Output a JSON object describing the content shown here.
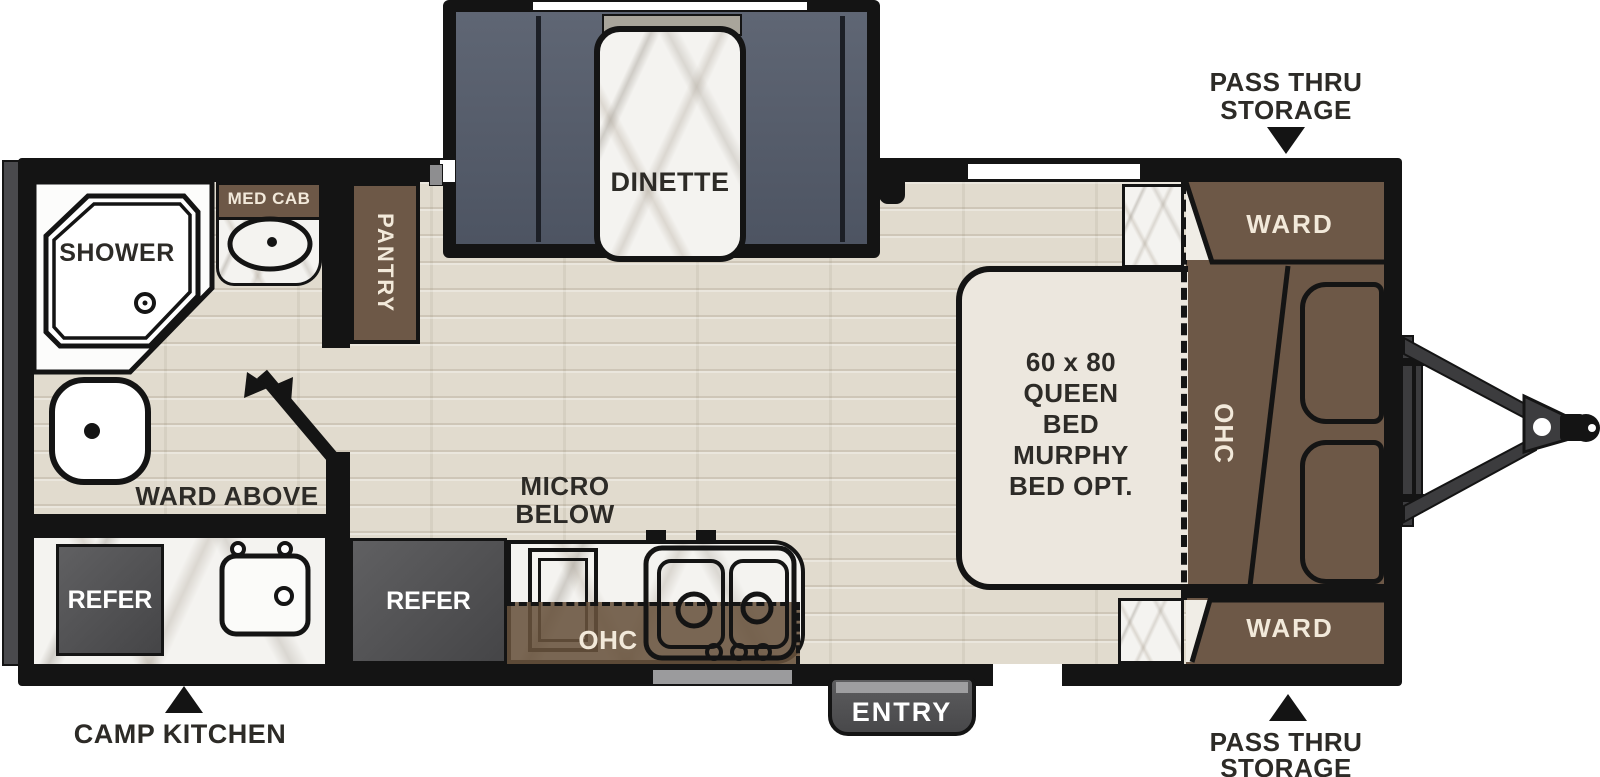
{
  "floorplan": {
    "type": "travel-trailer floor plan",
    "colors": {
      "walls": "#141414",
      "cabinet_brown": "#6d5847",
      "bench_slate": "#575e6c",
      "appliance_gray": "#4f4f51",
      "floor_wood": "#e1dbce",
      "counter_marble": "#f4f3f0",
      "bed_cream": "#ece7de",
      "label_dark": "#2d2b27",
      "label_cream": "#f2e9da"
    },
    "labels": {
      "dinette": "DINETTE",
      "shower": "SHOWER",
      "med_cab": "MED CAB",
      "pantry": "PANTRY",
      "ward_above": "WARD ABOVE",
      "camp_refer": "REFER",
      "camp_kitchen": "CAMP KITCHEN",
      "kitchen_refer": "REFER",
      "micro_below": [
        "MICRO",
        "BELOW"
      ],
      "kitchen_ohc": "OHC",
      "entry": "ENTRY",
      "bed": [
        "60 x 80",
        "QUEEN",
        "BED",
        "MURPHY",
        "BED OPT."
      ],
      "bedroom_ohc": "OHC",
      "ward_top": "WARD",
      "ward_bottom": "WARD",
      "pass_thru_top": [
        "PASS THRU",
        "STORAGE"
      ],
      "pass_thru_bottom": [
        "PASS THRU",
        "STORAGE"
      ]
    }
  }
}
